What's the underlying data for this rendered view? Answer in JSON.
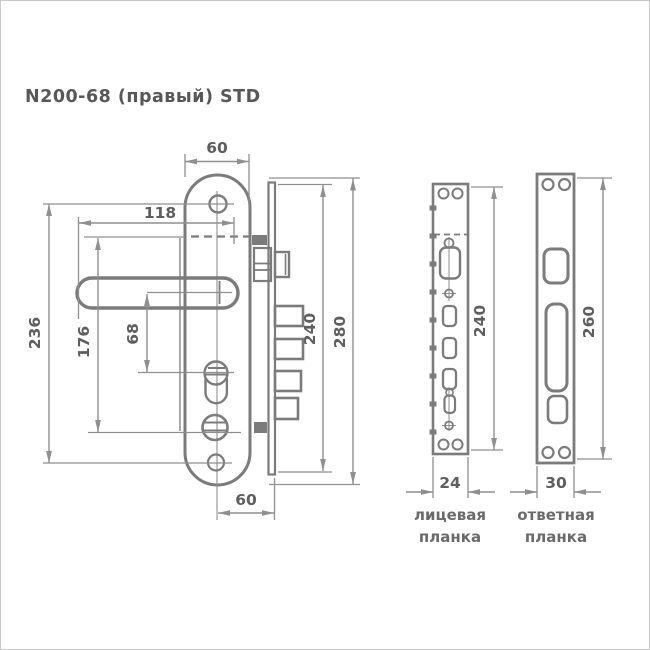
{
  "title": "N200-68 (правый) STD",
  "dims": {
    "plate_width_top": "60",
    "handle_length": "118",
    "screw_distance": "236",
    "handle_to_turn": "176",
    "handle_to_cylinder": "68",
    "lock_body_height": "240",
    "plate_total_height": "280",
    "backset_bottom": "60",
    "face_plate_height": "240",
    "face_plate_width": "24",
    "strike_plate_height": "260",
    "strike_plate_width": "30"
  },
  "labels": {
    "face_plate_line1": "лицевая",
    "face_plate_line2": "планка",
    "strike_plate_line1": "ответная",
    "strike_plate_line2": "планка"
  },
  "colors": {
    "outline": "#7b7b7b",
    "dimension": "#8f8f8f",
    "text": "#5e5e5e"
  }
}
